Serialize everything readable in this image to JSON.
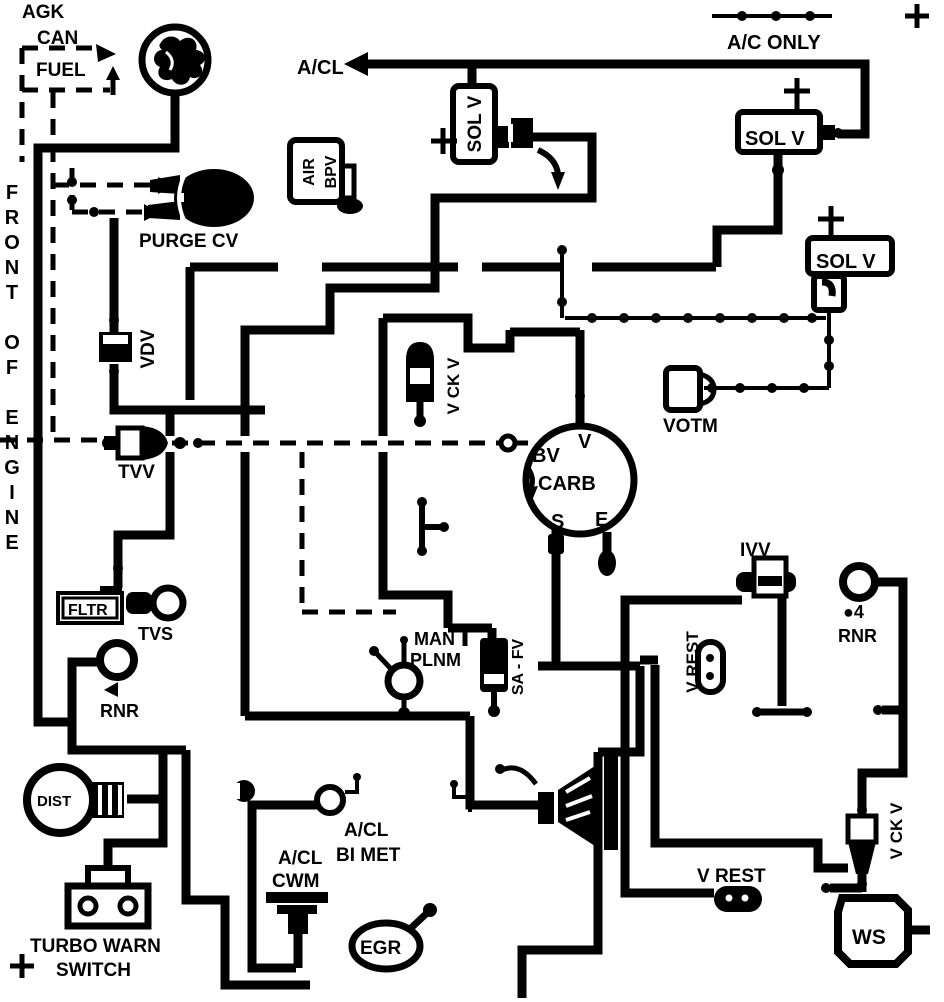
{
  "diagram": {
    "type": "vacuum-hose-routing-diagram",
    "orientation_note": "FRONT OF ENGINE"
  },
  "colors": {
    "line": "#000000",
    "background": "#ffffff"
  },
  "labels": {
    "agk": "AGK",
    "can": "CAN",
    "fuel": "FUEL",
    "front_of_engine": "FRONT OF ENGINE",
    "purge_cv": "PURGE CV",
    "acl": "A/CL",
    "ac_only": "A/C ONLY",
    "sol_v_carb": "SOL V",
    "sol_v_ac": "SOL V",
    "sol_v_votm": "SOL V",
    "air": "AIR",
    "bpv": "BPV",
    "vdv": "VDV",
    "tvv": "TVV",
    "v_ck_v_left": "V CK V",
    "v_ck_v_right": "V CK V",
    "bv": "BV",
    "v": "V",
    "carb": "CARB",
    "s": "S",
    "e": "E",
    "votm": "VOTM",
    "ivv": "IVV",
    "v_rest_mid": "V REST",
    "v_rest_bottom": "V REST",
    "rnr_4_bullet": "●4",
    "rnr_right": "RNR",
    "rnr_left": "RNR",
    "man": "MAN",
    "plnm": "PLNM",
    "sa_fv": "SA - FV",
    "fltr": "FLTR",
    "tvs": "TVS",
    "dist": "DIST",
    "turbo_warn": "TURBO WARN",
    "switch": "SWITCH",
    "acl_bimet_1": "A/CL",
    "acl_bimet_2": "BI MET",
    "acl_cwm_1": "A/CL",
    "acl_cwm_2": "CWM",
    "egr": "EGR",
    "ws": "WS"
  },
  "icons": {
    "plus-mark": "+",
    "arrow-left": "◄",
    "canister-tree": "vapor canister symbol",
    "beaded-line": "hose with bead dots",
    "dashed-line": "dashed vacuum hose"
  }
}
